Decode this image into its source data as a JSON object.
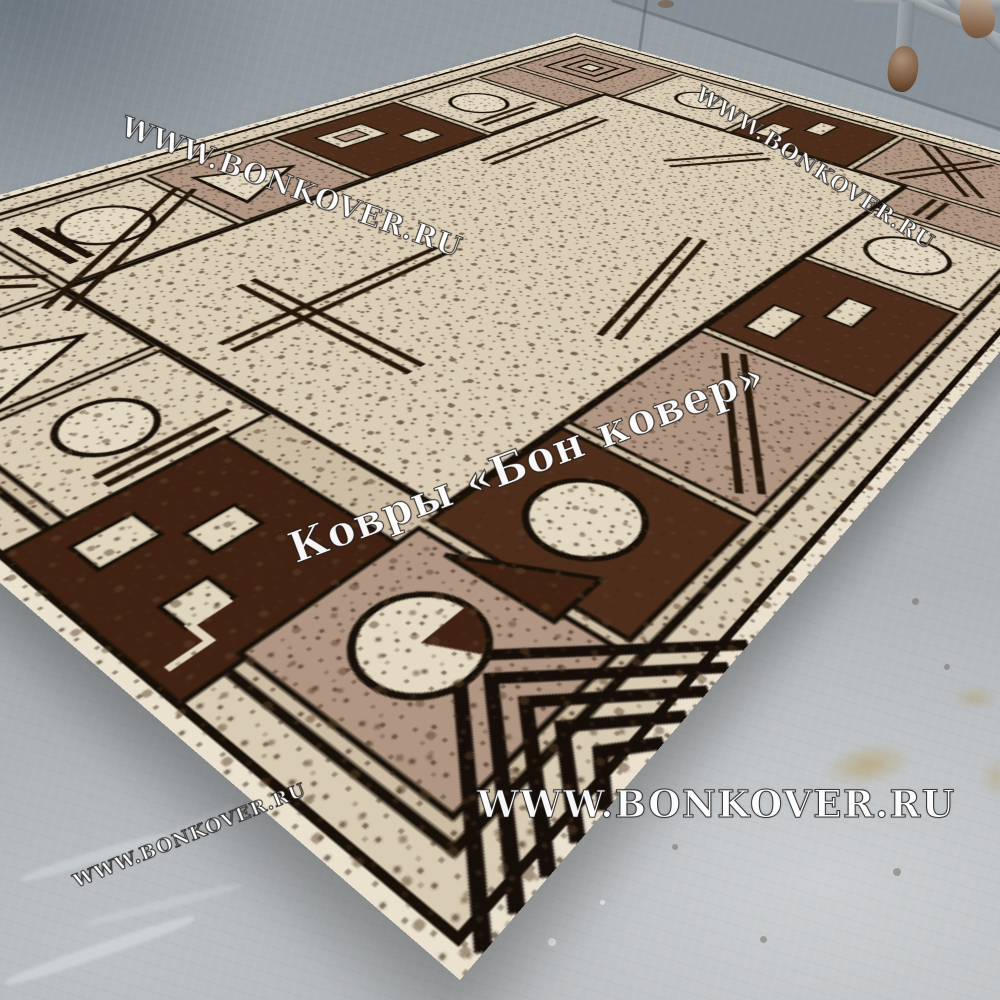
{
  "watermarks": {
    "top_left": "WWW.BONKOVER.RU",
    "top_right": "WWW.BONKOVER.RU",
    "center": "Ковры «Бон ковер»",
    "bottom_center": "WWW.BONKOVER.RU",
    "bottom_left": "WWW.BONKOVER.RU"
  },
  "colors": {
    "floor_dark": "#8e969d",
    "floor_mid": "#a7adb2",
    "floor_light": "#b8bbbd",
    "rug_selvedge": "#eae1cf",
    "rug_outer_band": "#d9ccb5",
    "rug_ring": "#cdbda4",
    "rug_field": "#dbceb7",
    "rug_taupe": "#b19683",
    "rug_brown": "#4e2d1b",
    "rug_brown_deep": "#412212",
    "rug_black": "#171008",
    "rug_motif_cream": "#e4dac4",
    "stick_brown": "#241609",
    "wm_fill": "#ffffff",
    "metal_gray": "#9aa0a4",
    "rust": "#8a6a50"
  }
}
